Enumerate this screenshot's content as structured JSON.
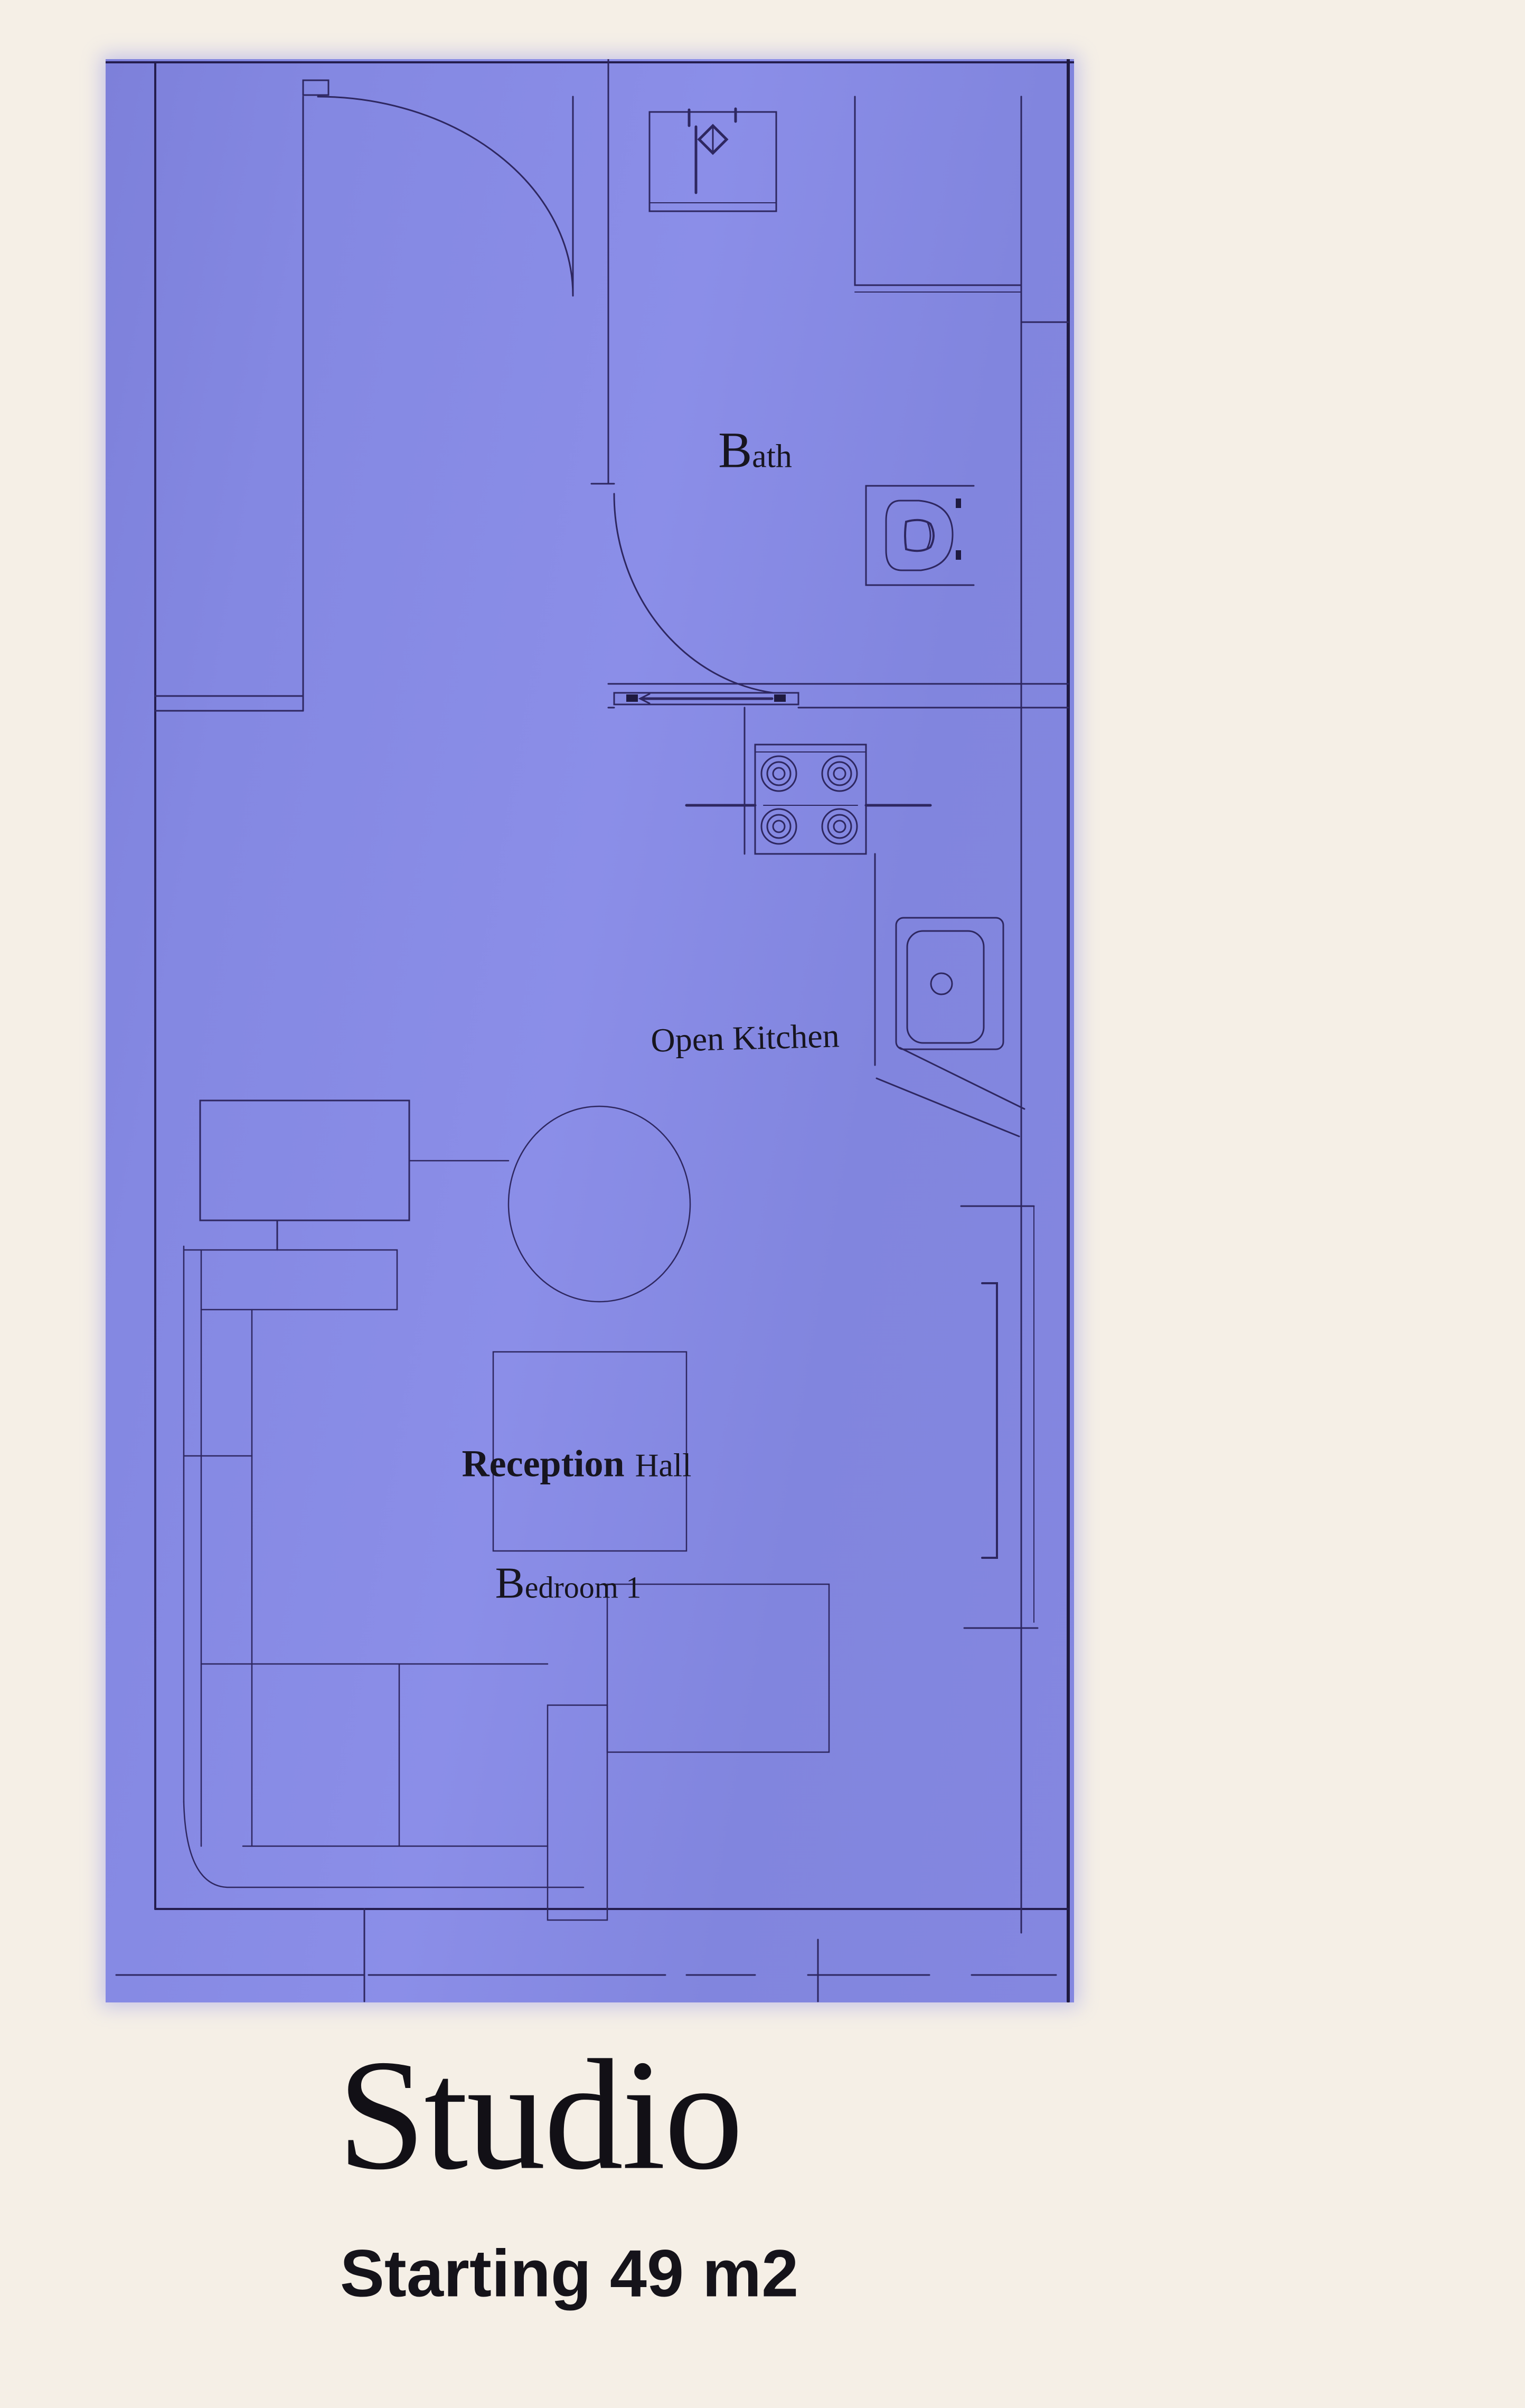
{
  "palette": {
    "page_background": "#f5efe6",
    "plan_background": "#8488e2",
    "line_color": "#2e2760",
    "text_color": "#17151f"
  },
  "plan": {
    "rooms": [
      {
        "id": "bath",
        "label": "Bath"
      },
      {
        "id": "open-kitchen",
        "label": "Open Kitchen"
      },
      {
        "id": "reception-hall",
        "label": "Reception",
        "label_suffix": "Hall"
      },
      {
        "id": "bedroom-1",
        "label": "Bedroom 1"
      }
    ],
    "fixtures": [
      {
        "id": "washbasin-icon",
        "name": "washbasin"
      },
      {
        "id": "shower-icon",
        "name": "shower tray"
      },
      {
        "id": "toilet-icon",
        "name": "toilet"
      },
      {
        "id": "stove-icon",
        "name": "4-burner stove"
      },
      {
        "id": "kitchen-sink-icon",
        "name": "kitchen sink"
      },
      {
        "id": "dining-table-icon",
        "name": "round dining table"
      },
      {
        "id": "tv-unit-icon",
        "name": "tv unit"
      },
      {
        "id": "sofa-icon",
        "name": "l-shaped sofa"
      },
      {
        "id": "rug-icon",
        "name": "rug"
      },
      {
        "id": "bed-bench-icon",
        "name": "bench / bed"
      },
      {
        "id": "entry-door-icon",
        "name": "entry door swing"
      },
      {
        "id": "bath-door-icon",
        "name": "bath door swing"
      }
    ]
  },
  "caption": {
    "title": "Studio",
    "subtitle": "Starting 49 m2"
  }
}
